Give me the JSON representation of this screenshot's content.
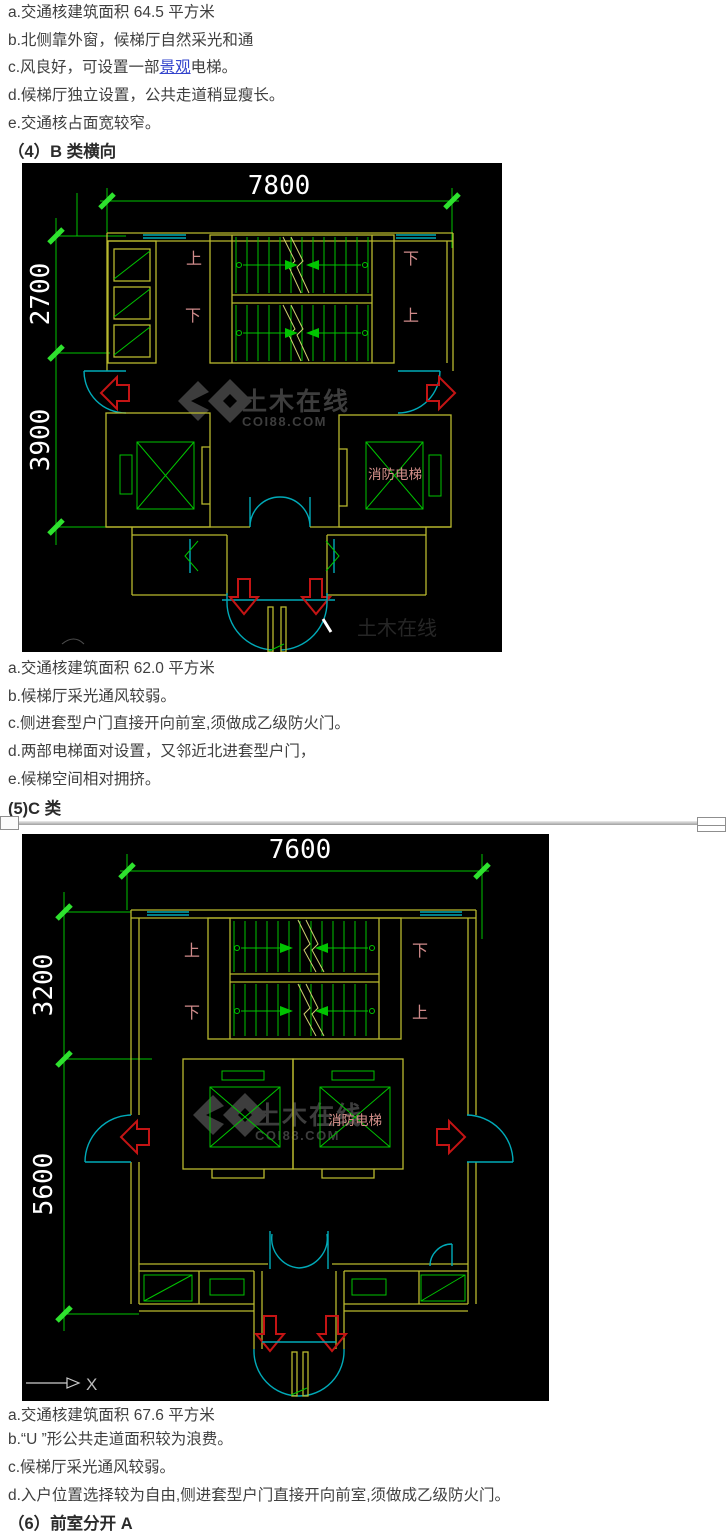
{
  "page": {
    "background": "#ffffff",
    "text_color": "#3f3f3f",
    "link_color": "#3344cc",
    "heading_color": "#2b2b2b"
  },
  "notes_top": {
    "line_a": "a.交通核建筑面积 64.5 平方米",
    "line_b": "b.北侧靠外窗，候梯厅自然采光和通",
    "line_c_pre": "c.风良好，可设置一部",
    "line_c_link": "景观",
    "line_c_post": "电梯。",
    "line_d": "d.候梯厅独立设置，公共走道稍显瘦长。",
    "line_e": "e.交通核占面宽较窄。",
    "heading": "（4）B 类横向"
  },
  "notes_middle": {
    "line_a": "a.交通核建筑面积 62.0 平方米",
    "line_b": "b.候梯厅采光通风较弱。",
    "line_c": "c.侧进套型户门直接开向前室,须做成乙级防火门。",
    "line_d": "d.两部电梯面对设置，又邻近北进套型户门，",
    "line_e": "e.候梯空间相对拥挤。",
    "heading": "(5)C 类"
  },
  "notes_bottom": {
    "line_a": "a.交通核建筑面积 67.6 平方米",
    "line_b": "b.“U ”形公共走道面积较为浪费。",
    "line_c": "c.候梯厅采光通风较弱。",
    "line_d": "d.入户位置选择较为自由,侧进套型户门直接开向前室,须做成乙级防火门。",
    "heading": "（6）前室分开 A"
  },
  "plan_b": {
    "dim_width": "7800",
    "dim_left_upper": "2700",
    "dim_left_lower": "3900",
    "stair_label_top_left": "上",
    "stair_label_top_right": "下",
    "stair_label_bottom_left": "下",
    "stair_label_bottom_right": "上",
    "fire_elevator_label": "消防电梯",
    "watermark_name": "土木在线",
    "watermark_site": "COI88.COM"
  },
  "plan_c": {
    "dim_width": "7600",
    "dim_left_upper": "3200",
    "dim_left_lower": "5600",
    "stair_label_top_left": "上",
    "stair_label_top_right": "下",
    "stair_label_bottom_left": "下",
    "stair_label_bottom_right": "上",
    "fire_elevator_label": "消防电梯",
    "watermark_name": "土木在线",
    "watermark_site": "COI88.COM",
    "axis_x_label": "X"
  },
  "cad_colors": {
    "background": "#000000",
    "wall_yellow": "#b9b92e",
    "stair_green": "#00c400",
    "tick_green": "#2ee22e",
    "dim_text_white": "#ffffff",
    "cjk_label_salmon": "#cf8a8a",
    "door_cyan": "#00aab8",
    "arrow_red": "#c41414",
    "watermark_gray": "#3d3d3d"
  }
}
